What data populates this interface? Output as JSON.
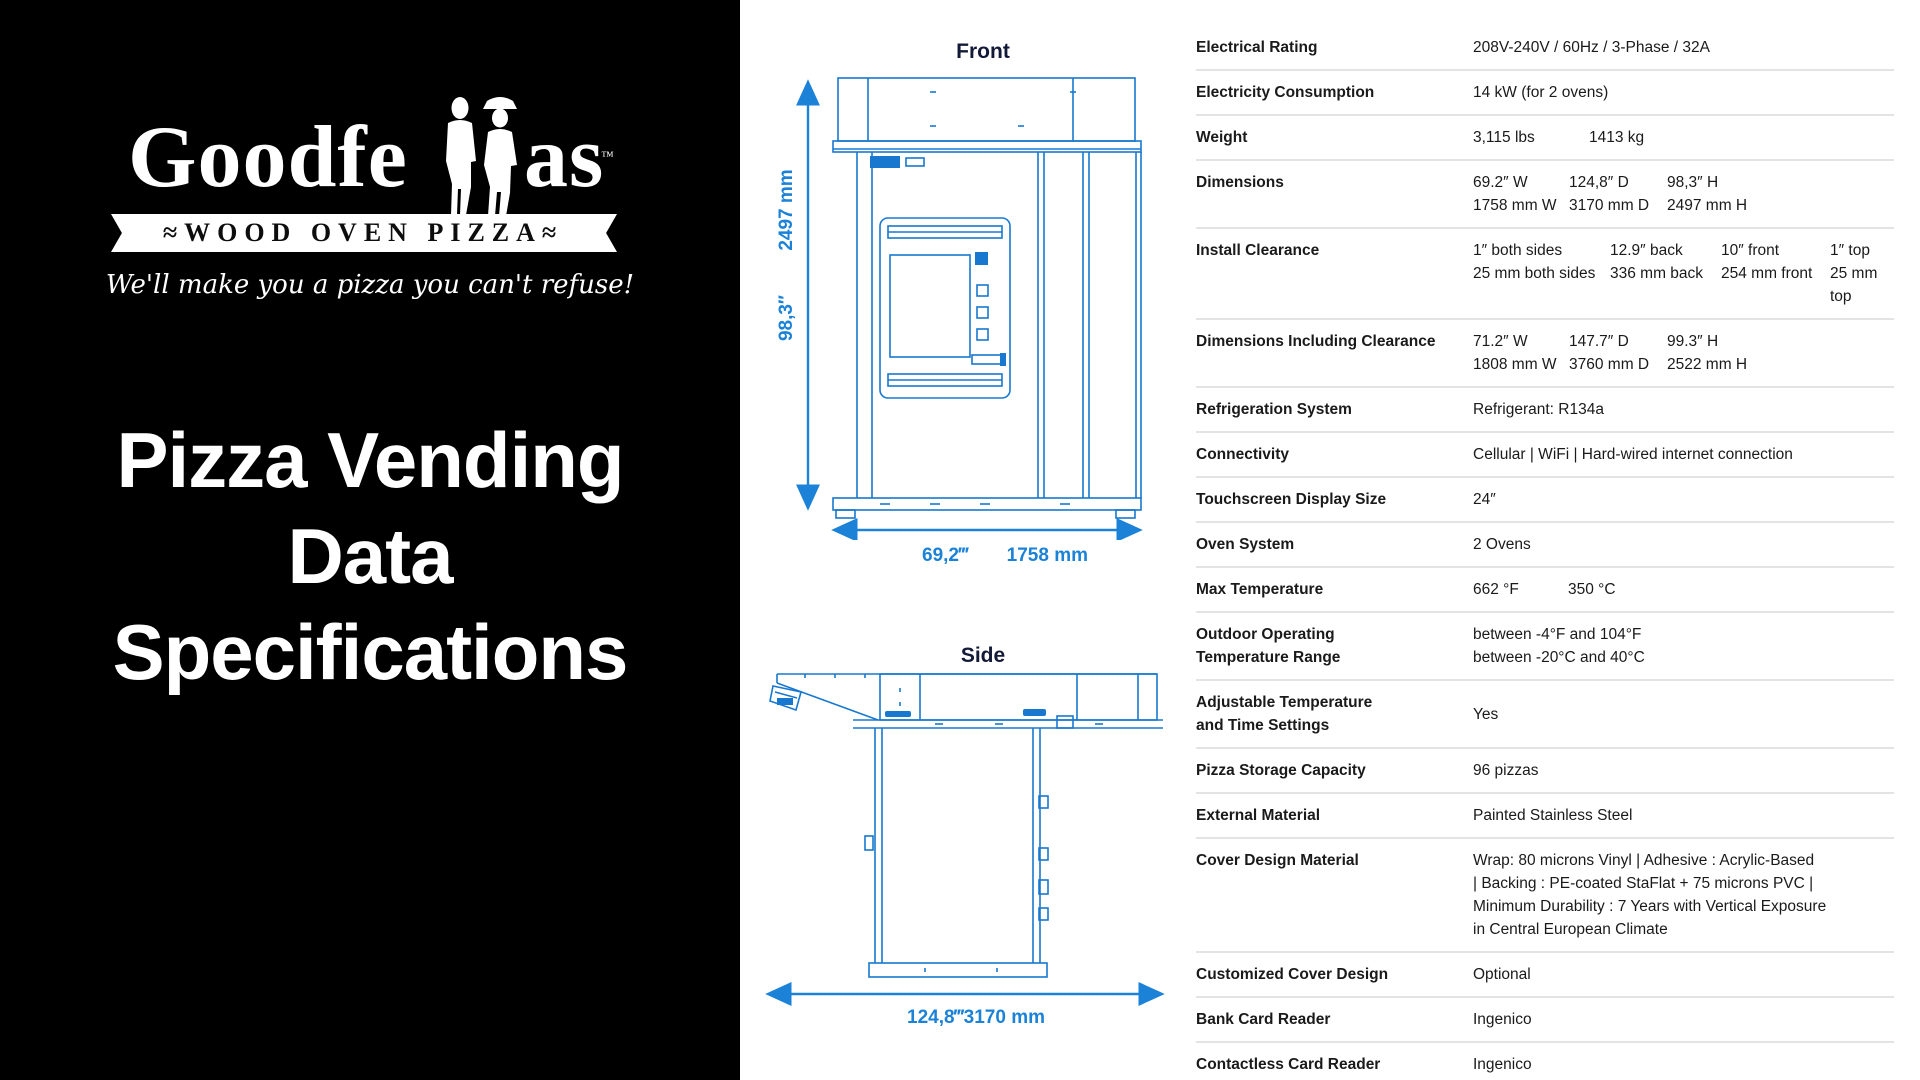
{
  "colors": {
    "panel_black": "#000000",
    "diagram_blue": "#1b82d8",
    "title_navy": "#131a38",
    "divider_gray": "#e3e3e3"
  },
  "left_panel": {
    "logo": {
      "brand_part1": "Goodfe",
      "brand_part2": "as",
      "trademark": "™",
      "banner": "≈WOOD OVEN PIZZA≈",
      "tagline": "We'll make you a pizza you can't refuse!"
    },
    "title_lines": [
      "Pizza Vending",
      "Data",
      "Specifications"
    ]
  },
  "diagrams": {
    "front": {
      "title": "Front",
      "height_mm": "2497 mm",
      "height_in": "98,3″",
      "width_in": "69,2‴",
      "width_mm": "1758 mm"
    },
    "side": {
      "title": "Side",
      "depth_in": "124,8‴",
      "depth_mm": "3170 mm"
    }
  },
  "specs": {
    "electrical_rating": {
      "label": "Electrical Rating",
      "value": "208V-240V / 60Hz / 3-Phase / 32A"
    },
    "electricity_consumption": {
      "label": "Electricity Consumption",
      "value": "14 kW (for 2 ovens)"
    },
    "weight": {
      "label": "Weight",
      "lbs": "3,115 lbs",
      "kg": "1413 kg"
    },
    "dimensions": {
      "label": "Dimensions",
      "in": [
        "69.2″ W",
        "124,8″ D",
        "98,3″ H"
      ],
      "mm": [
        "1758 mm W",
        "3170 mm D",
        "2497 mm H"
      ]
    },
    "install_clearance": {
      "label": "Install Clearance",
      "in": [
        "1″ both sides",
        "12.9″ back",
        "10″ front",
        "1″ top"
      ],
      "mm": [
        "25 mm both sides",
        "336 mm back",
        "254 mm front",
        "25 mm top"
      ]
    },
    "dimensions_clearance": {
      "label": "Dimensions Including Clearance",
      "in": [
        "71.2″ W",
        "147.7″ D",
        "99.3″ H"
      ],
      "mm": [
        "1808 mm W",
        "3760 mm D",
        "2522 mm H"
      ]
    },
    "refrigeration": {
      "label": "Refrigeration System",
      "value": "Refrigerant: R134a"
    },
    "connectivity": {
      "label": "Connectivity",
      "value": "Cellular | WiFi | Hard-wired internet connection"
    },
    "touchscreen": {
      "label": "Touchscreen Display Size",
      "value": "24″"
    },
    "oven_system": {
      "label": "Oven System",
      "value": "2 Ovens"
    },
    "max_temperature": {
      "label": "Max Temperature",
      "f": "662 °F",
      "c": "350 °C"
    },
    "outdoor_range": {
      "label_lines": [
        "Outdoor Operating",
        "Temperature Range"
      ],
      "lines": [
        "between -4°F and 104°F",
        "between -20°C and 40°C"
      ]
    },
    "adjustable": {
      "label_lines": [
        "Adjustable Temperature",
        "and Time Settings"
      ],
      "value": "Yes"
    },
    "pizza_storage": {
      "label": "Pizza Storage Capacity",
      "value": "96 pizzas"
    },
    "external_material": {
      "label": "External Material",
      "value": "Painted Stainless Steel"
    },
    "cover_material": {
      "label": "Cover Design Material",
      "lines": [
        "Wrap: 80 microns Vinyl | Adhesive : Acrylic-Based",
        "| Backing : PE-coated StaFlat + 75 microns PVC |",
        "Minimum Durability : 7 Years with Vertical Exposure",
        "in Central European Climate"
      ]
    },
    "customized_cover": {
      "label": "Customized Cover Design",
      "value": "Optional"
    },
    "bank_card": {
      "label": "Bank Card Reader",
      "value": "Ingenico"
    },
    "contactless_card": {
      "label": "Contactless Card Reader",
      "value": "Ingenico"
    }
  }
}
